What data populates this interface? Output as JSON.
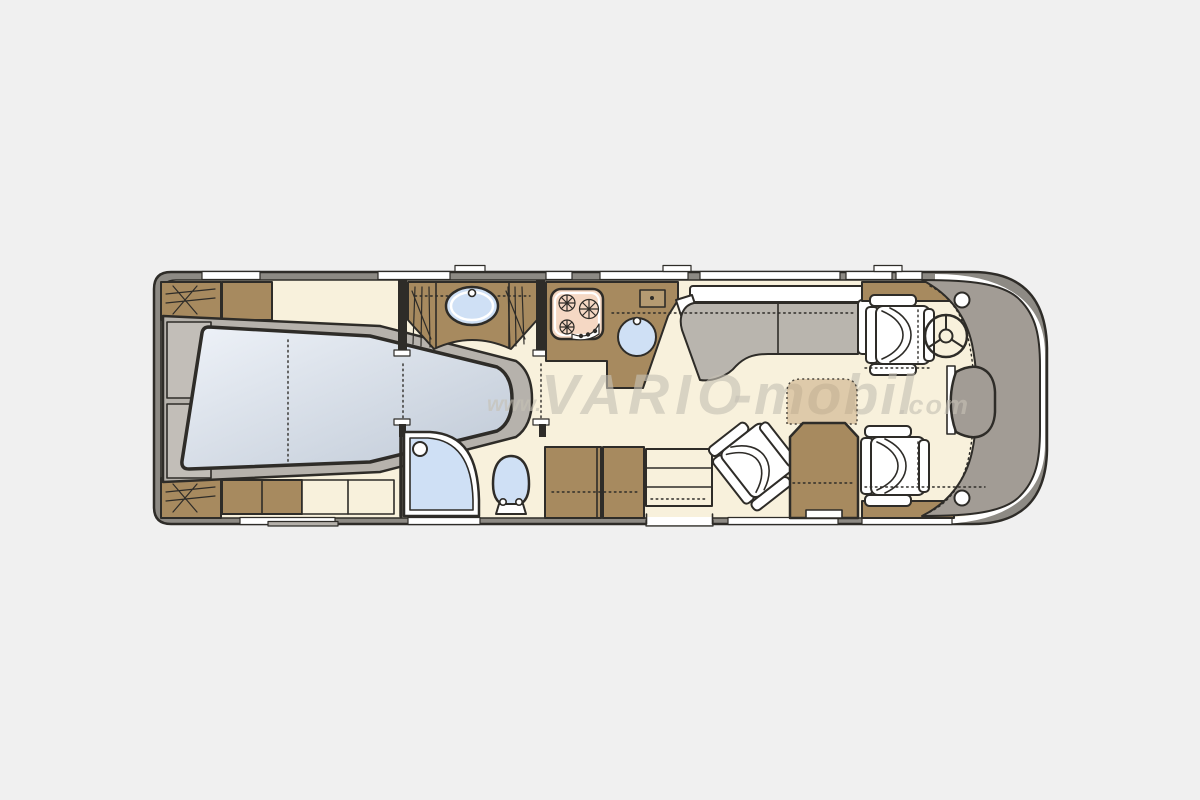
{
  "watermark": {
    "prefix": "www.",
    "brand": "VARIO",
    "suffix": "-mobil",
    "domain": ".com"
  },
  "palette": {
    "bg": "#f0f0f0",
    "wall": "#8d8a84",
    "floor": "#f8f1dc",
    "brown": "#a78a5f",
    "sofa": "#b9b5ae",
    "fixture": "#cfe0f5",
    "cooktop": "#f5d8c4",
    "cab": "#a29c95",
    "platform": "#b6b2ac",
    "mattress-light": "#edf2f8",
    "mattress-dark": "#bfc9d6",
    "outline": "#2e2c28",
    "watermark": "#c6c1b5",
    "table-extension": "#c3a478"
  },
  "floorplan": {
    "type": "motorhome top-view floor plan",
    "areas": [
      {
        "name": "rear-bedroom",
        "items": [
          "island-bed",
          "wardrobe",
          "wardrobe",
          "dresser",
          "cabinet"
        ]
      },
      {
        "name": "washroom",
        "items": [
          "washbasin",
          "wardrobe",
          "wardrobe",
          "sliding-doors"
        ]
      },
      {
        "name": "shower-room",
        "items": [
          "shower",
          "toilet"
        ]
      },
      {
        "name": "kitchen",
        "items": [
          "cooktop-3-burner",
          "round-sink",
          "counter"
        ]
      },
      {
        "name": "lounge",
        "items": [
          "sofa"
        ]
      },
      {
        "name": "dinette",
        "items": [
          "swivel-chair",
          "table",
          "table-extension",
          "entry-steps",
          "tall-cabinet"
        ]
      },
      {
        "name": "cab",
        "items": [
          "driver-seat",
          "steering-wheel",
          "passenger-seat",
          "dashboard",
          "engine-console"
        ]
      }
    ]
  }
}
